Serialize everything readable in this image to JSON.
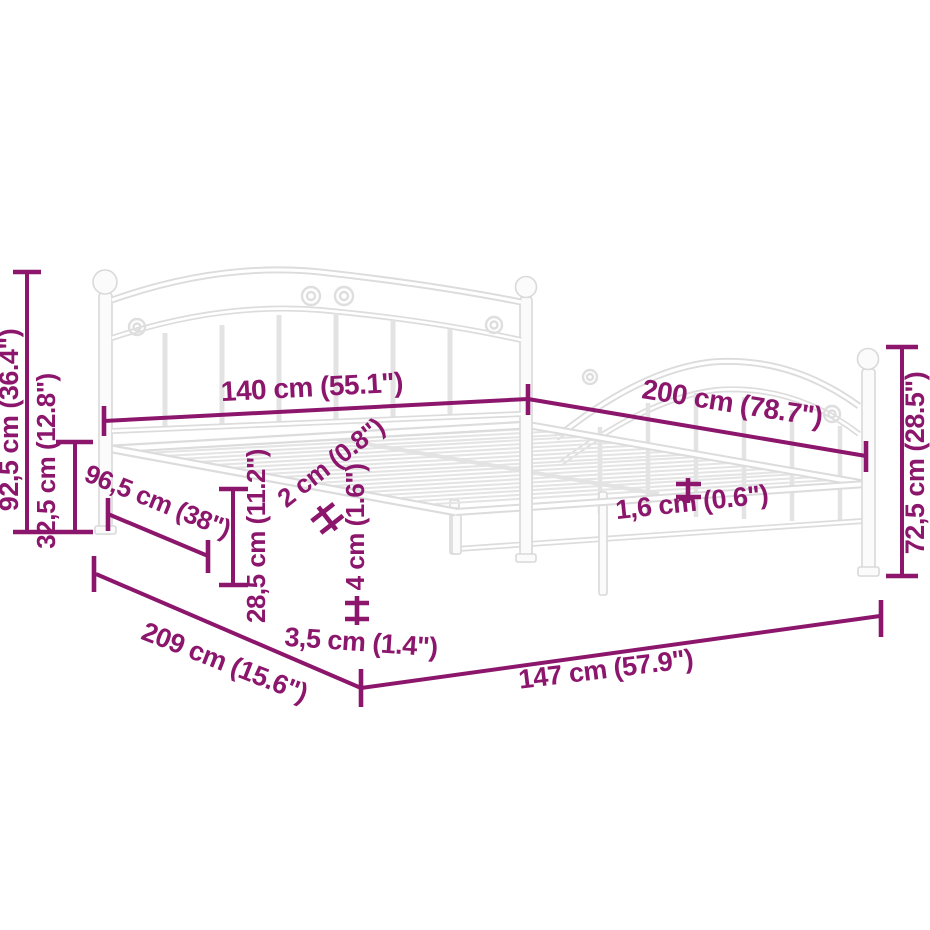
{
  "diagram_title": "Metal bed frame dimension diagram",
  "colors": {
    "dimension": "#8B166C",
    "frame_line": "#DCDCDC",
    "background": "#FFFFFF"
  },
  "labels": {
    "l92_5": "92,5 cm (36.4\")",
    "l32_5": "32,5 cm (12.8\")",
    "l140": "140 cm (55.1\")",
    "l200": "200 cm (78.7\")",
    "l72_5": "72,5 cm (28.5\")",
    "l96_5": "96,5 cm (38\")",
    "l28_5": "28,5 cm (11.2\")",
    "l2": "2 cm (0.8\")",
    "l4": "4 cm (1.6\")",
    "l1_6": "1,6 cm (0.6\")",
    "l3_5": "3,5 cm (1.4\")",
    "l209": "209 cm (15.6\")",
    "l147": "147 cm (57.9\")"
  }
}
